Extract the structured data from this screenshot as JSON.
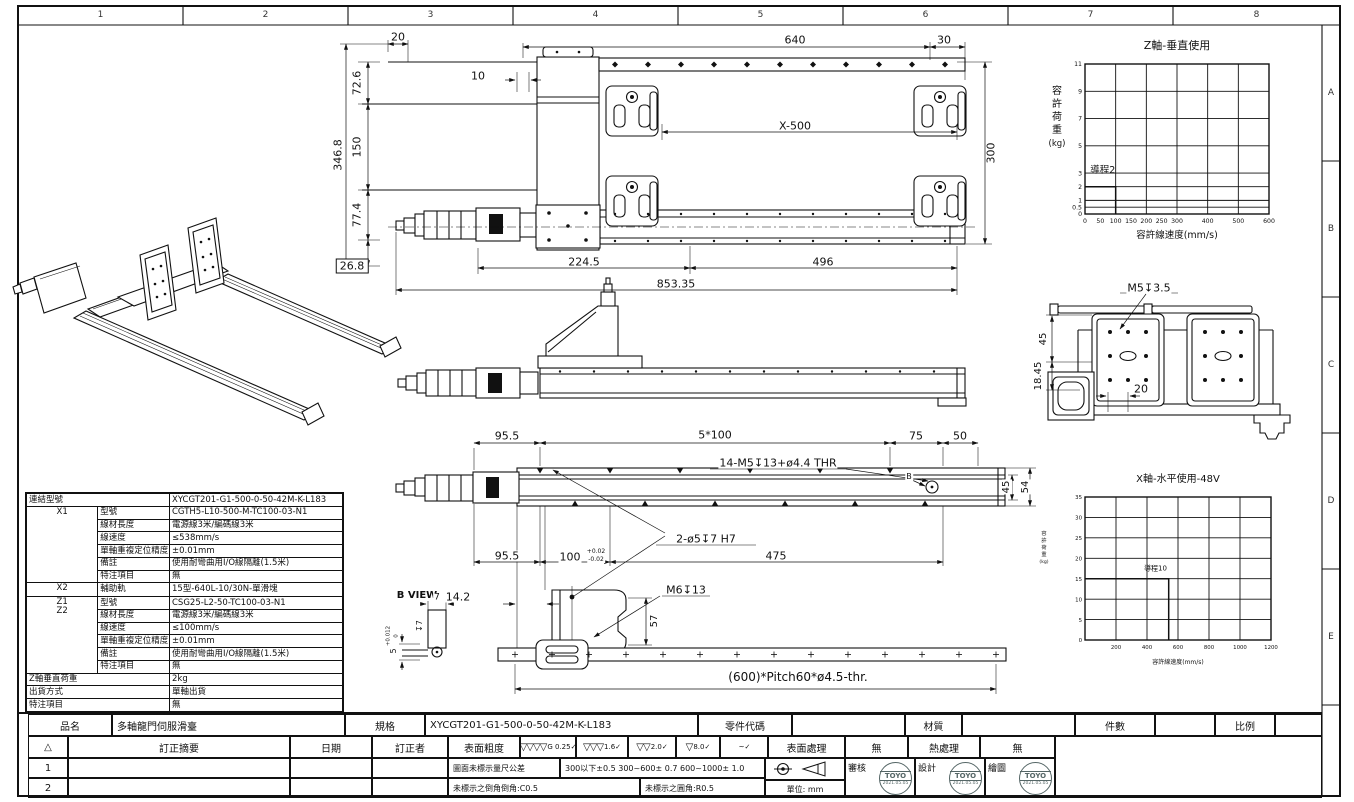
{
  "border": {
    "columns": [
      "1",
      "2",
      "3",
      "4",
      "5",
      "6",
      "7",
      "8"
    ],
    "rows": [
      "A",
      "B",
      "C",
      "D",
      "E"
    ]
  },
  "chart_data": [
    {
      "type": "line",
      "title": "Z軸-垂直使用",
      "xlabel": "容許線速度(mm/s)",
      "ylabel": "容許荷重",
      "ylabel_unit": "(kg)",
      "xlim": [
        0,
        600
      ],
      "ylim": [
        0,
        11
      ],
      "x_ticks": [
        0,
        50,
        100,
        150,
        200,
        250,
        300,
        400,
        500,
        600
      ],
      "x_grid": [
        100,
        200,
        300,
        400,
        500
      ],
      "y_ticks": [
        0,
        0.5,
        1,
        2,
        3,
        5,
        7,
        9,
        11
      ],
      "grid": true,
      "legend": "none",
      "series": [
        {
          "name": "導程2",
          "points": [
            [
              0,
              2
            ],
            [
              100,
              2
            ],
            [
              100,
              0
            ]
          ]
        }
      ],
      "annotations": [
        {
          "text": "導程2",
          "x": 58,
          "y": 3
        }
      ]
    },
    {
      "type": "line",
      "title": "X軸-水平使用-48V",
      "xlabel": "容許線速度(mm/s)",
      "ylabel": "容許荷重",
      "ylabel_unit": "(kg)",
      "xlim": [
        0,
        1200
      ],
      "ylim": [
        0,
        35
      ],
      "x_ticks": [
        200,
        400,
        600,
        800,
        1000,
        1200
      ],
      "x_grid": [
        200,
        400,
        600,
        800,
        1000
      ],
      "y_ticks": [
        0,
        5,
        10,
        15,
        20,
        25,
        30,
        35
      ],
      "grid": true,
      "legend": "none",
      "series": [
        {
          "name": "導程10",
          "points": [
            [
              0,
              15
            ],
            [
              540,
              15
            ],
            [
              540,
              0
            ]
          ]
        }
      ],
      "annotations": [
        {
          "text": "導程10",
          "x": 455,
          "y": 17
        }
      ]
    }
  ],
  "spec_table": {
    "rows": [
      {
        "label": "連結型號",
        "value": "XYCGT201-G1-500-0-50-42M-K-L183",
        "span": true
      },
      {
        "group": "X1",
        "grow": 6,
        "label": "型號",
        "value": "CGTH5-L10-500-M-TC100-03-N1"
      },
      {
        "label": "線材長度",
        "value": "電源線3米/編碼線3米"
      },
      {
        "label": "線速度",
        "value": "≤538mm/s"
      },
      {
        "label": "單軸重複定位精度",
        "value": "±0.01mm"
      },
      {
        "label": "備註",
        "value": "使用耐彎曲用I/O線隔離(1.5米)"
      },
      {
        "label": "特注項目",
        "value": "無"
      },
      {
        "group": "X2",
        "grow": 1,
        "label": "輔助軌",
        "value": "15型-640L-10/30N-單滑塊"
      },
      {
        "group": "Z1\nZ2",
        "grow": 6,
        "label": "型號",
        "value": "CSG25-L2-50-TC100-03-N1"
      },
      {
        "label": "線材長度",
        "value": "電源線3米/編碼線3米"
      },
      {
        "label": "線速度",
        "value": "≤100mm/s"
      },
      {
        "label": "單軸重複定位精度",
        "value": "±0.01mm"
      },
      {
        "label": "備註",
        "value": "使用耐彎曲用I/O線隔離(1.5米)"
      },
      {
        "label": "特注項目",
        "value": "無"
      },
      {
        "label": "Z軸垂直荷重",
        "value": "2kg",
        "span": true
      },
      {
        "label": "出貨方式",
        "value": "單軸出貨",
        "span": true
      },
      {
        "label": "特注項目",
        "value": "無",
        "span": true
      }
    ]
  },
  "title_block": {
    "pin_label": "品名",
    "pin_value": "多軸龍門伺服滑臺",
    "spec_label": "規格",
    "spec_value": "XYCGT201-G1-500-0-50-42M-K-L183",
    "part_code_label": "零件代碼",
    "material_label": "材質",
    "qty_label": "件數",
    "scale_label": "比例",
    "rev_mark": "△",
    "rev_summary_label": "訂正摘要",
    "date_label": "日期",
    "reviser_label": "訂正者",
    "roughness_label": "表面粗度",
    "roughness_symbols": [
      {
        "prefix": "G",
        "value": "0.25",
        "triangles": 4
      },
      {
        "prefix": "",
        "value": "1.6",
        "triangles": 3
      },
      {
        "prefix": "",
        "value": "2.0",
        "triangles": 2
      },
      {
        "prefix": "",
        "value": "8.0",
        "triangles": 1
      },
      {
        "prefix": "",
        "value": "~",
        "triangles": 0
      }
    ],
    "surface_label": "表面處理",
    "surface_value": "無",
    "heat_label": "熱處理",
    "heat_value": "無",
    "rev_rows": [
      "1",
      "2"
    ],
    "tolerance_note_label": "圖面未標示量尺公差",
    "tolerance_note_value": "300以下±0.5  300~600± 0.7  600~1000± 1.0",
    "chamfer_note": "未標示之倒角倒角:C0.5",
    "fillet_note": "未標示之圓角:R0.5",
    "unit_label": "單位: mm",
    "approvals": [
      {
        "role": "審核",
        "stamp": "TOYO",
        "date": "2021.05.05"
      },
      {
        "role": "設計",
        "stamp": "TOYO",
        "date": "2021.05.05"
      },
      {
        "role": "繪圖",
        "stamp": "TOYO",
        "date": "2021.05.05"
      }
    ]
  },
  "dimensions": [
    {
      "text": "20",
      "x": 398,
      "y": 37
    },
    {
      "text": "640",
      "x": 795,
      "y": 40
    },
    {
      "text": "30",
      "x": 944,
      "y": 40
    },
    {
      "text": "10",
      "x": 478,
      "y": 76
    },
    {
      "text": "72.6",
      "x": 357,
      "y": 83,
      "rot": true
    },
    {
      "text": "150",
      "x": 357,
      "y": 147,
      "rot": true
    },
    {
      "text": "77.4",
      "x": 357,
      "y": 215,
      "rot": true
    },
    {
      "text": "346.8",
      "x": 338,
      "y": 155,
      "rot": true
    },
    {
      "text": "26.8",
      "x": 352,
      "y": 266,
      "box": true
    },
    {
      "text": "X-500",
      "x": 795,
      "y": 126
    },
    {
      "text": "300",
      "x": 991,
      "y": 153,
      "rot": true
    },
    {
      "text": "224.5",
      "x": 584,
      "y": 262
    },
    {
      "text": "496",
      "x": 823,
      "y": 262
    },
    {
      "text": "853.35",
      "x": 676,
      "y": 284
    },
    {
      "text": "95.5",
      "x": 507,
      "y": 436
    },
    {
      "text": "5*100",
      "x": 715,
      "y": 435
    },
    {
      "text": "75",
      "x": 916,
      "y": 436
    },
    {
      "text": "50",
      "x": 960,
      "y": 436
    },
    {
      "text": "14-M5↧13+ø4.4 THR",
      "x": 778,
      "y": 463
    },
    {
      "text": "B",
      "x": 909,
      "y": 477,
      "fs": 8
    },
    {
      "text": "45",
      "x": 1007,
      "y": 487,
      "rot": true,
      "fs": 10
    },
    {
      "text": "54",
      "x": 1026,
      "y": 487,
      "rot": true,
      "fs": 10
    },
    {
      "text": "2-ø5↧7 H7",
      "x": 706,
      "y": 539
    },
    {
      "text": "95.5",
      "x": 507,
      "y": 556
    },
    {
      "text": "100",
      "x": 570,
      "y": 557
    },
    {
      "text": "+0.02",
      "x": 596,
      "y": 552,
      "fs": 6
    },
    {
      "text": "-0.02",
      "x": 596,
      "y": 560,
      "fs": 6
    },
    {
      "text": "475",
      "x": 776,
      "y": 556
    },
    {
      "text": "14.2",
      "x": 458,
      "y": 597
    },
    {
      "text": "M6↧13",
      "x": 686,
      "y": 590
    },
    {
      "text": "57",
      "x": 655,
      "y": 621,
      "rot": true,
      "fs": 10
    },
    {
      "text": "B VIEW",
      "x": 417,
      "y": 596,
      "fs": 10,
      "bold": true
    },
    {
      "text": "7",
      "x": 437,
      "y": 598,
      "fs": 9
    },
    {
      "text": "↧7",
      "x": 420,
      "y": 626,
      "rot": true,
      "fs": 8
    },
    {
      "text": "5",
      "x": 394,
      "y": 651,
      "rot": true,
      "fs": 8
    },
    {
      "text": "+0.012",
      "x": 389,
      "y": 636,
      "rot": true,
      "fs": 5.5
    },
    {
      "text": "0",
      "x": 397,
      "y": 636,
      "rot": true,
      "fs": 5.5
    },
    {
      "text": "(600)*Pitch60*ø4.5-thr.",
      "x": 798,
      "y": 677,
      "fs": 12
    },
    {
      "text": "M5↧3.5",
      "x": 1149,
      "y": 288
    },
    {
      "text": "45",
      "x": 1044,
      "y": 339,
      "rot": true,
      "fs": 10
    },
    {
      "text": "18.45",
      "x": 1039,
      "y": 376,
      "rot": true,
      "fs": 10
    },
    {
      "text": "20",
      "x": 1141,
      "y": 389
    }
  ]
}
